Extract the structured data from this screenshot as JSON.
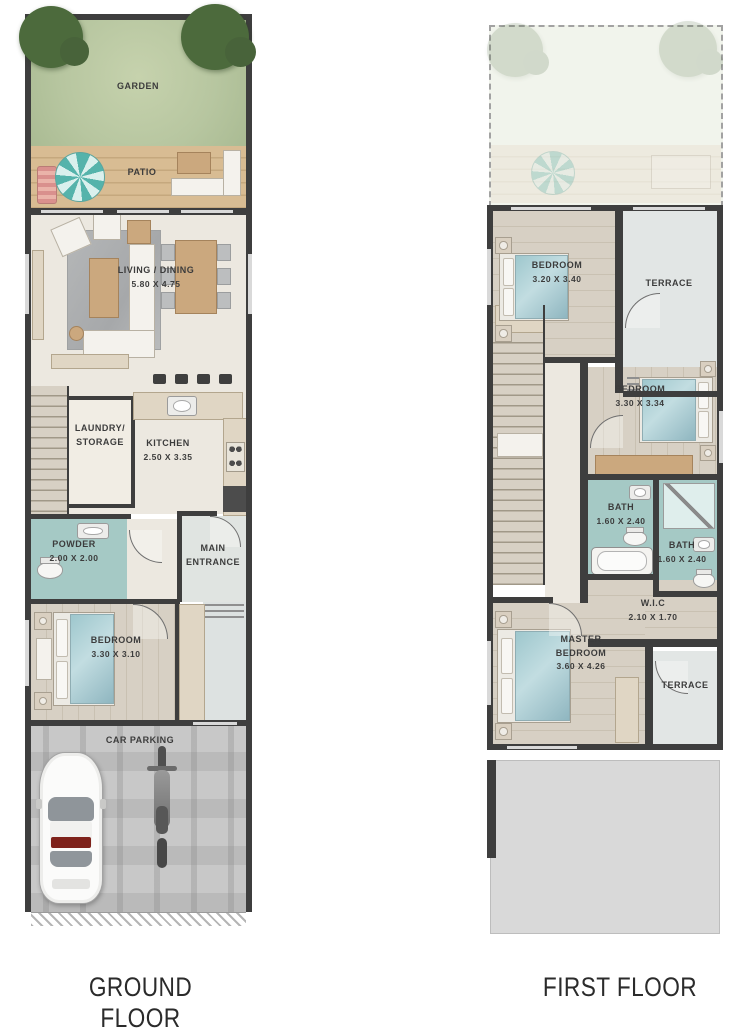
{
  "ground": {
    "title": "GROUND FLOOR",
    "rooms": {
      "garden": {
        "label": "GARDEN"
      },
      "patio": {
        "label": "PATIO"
      },
      "living_dining": {
        "label": "LIVING / DINING",
        "dims": "5.80 X 4.75"
      },
      "laundry_storage": {
        "label": "LAUNDRY/\nSTORAGE"
      },
      "kitchen": {
        "label": "KITCHEN",
        "dims": "2.50 X 3.35"
      },
      "powder": {
        "label": "POWDER",
        "dims": "2.00 X 2.00"
      },
      "main_entrance": {
        "label": "MAIN\nENTRANCE"
      },
      "bedroom": {
        "label": "BEDROOM",
        "dims": "3.30 X 3.10"
      },
      "car_parking": {
        "label": "CAR PARKING"
      }
    }
  },
  "first": {
    "title": "FIRST FLOOR",
    "rooms": {
      "bedroom_1": {
        "label": "BEDROOM",
        "dims": "3.20 X 3.40"
      },
      "terrace_1": {
        "label": "TERRACE"
      },
      "bedroom_2": {
        "label": "BEDROOM",
        "dims": "3.30 X 3.34"
      },
      "bath_1": {
        "label": "BATH",
        "dims": "1.60 X 2.40"
      },
      "bath_2": {
        "label": "BATH",
        "dims": "1.60 X 2.40"
      },
      "wic": {
        "label": "W.I.C",
        "dims": "2.10 X 1.70"
      },
      "master_bedroom": {
        "label": "MASTER\nBEDROOM",
        "dims": "3.60 X 4.26"
      },
      "terrace_2": {
        "label": "TERRACE"
      }
    }
  },
  "palette": {
    "wall": "#3e3e3e",
    "garden_green": "#b7c6a0",
    "patio_wood": "#d2b58c",
    "floor_cream": "#ece8e0",
    "bedroom_wood": "#d6cfc3",
    "bath_teal": "#a5c9c5",
    "terrace_gray": "#e2e6e5",
    "parking_gray": "#c8c8c8",
    "accent_teal": "#57b6ae"
  }
}
